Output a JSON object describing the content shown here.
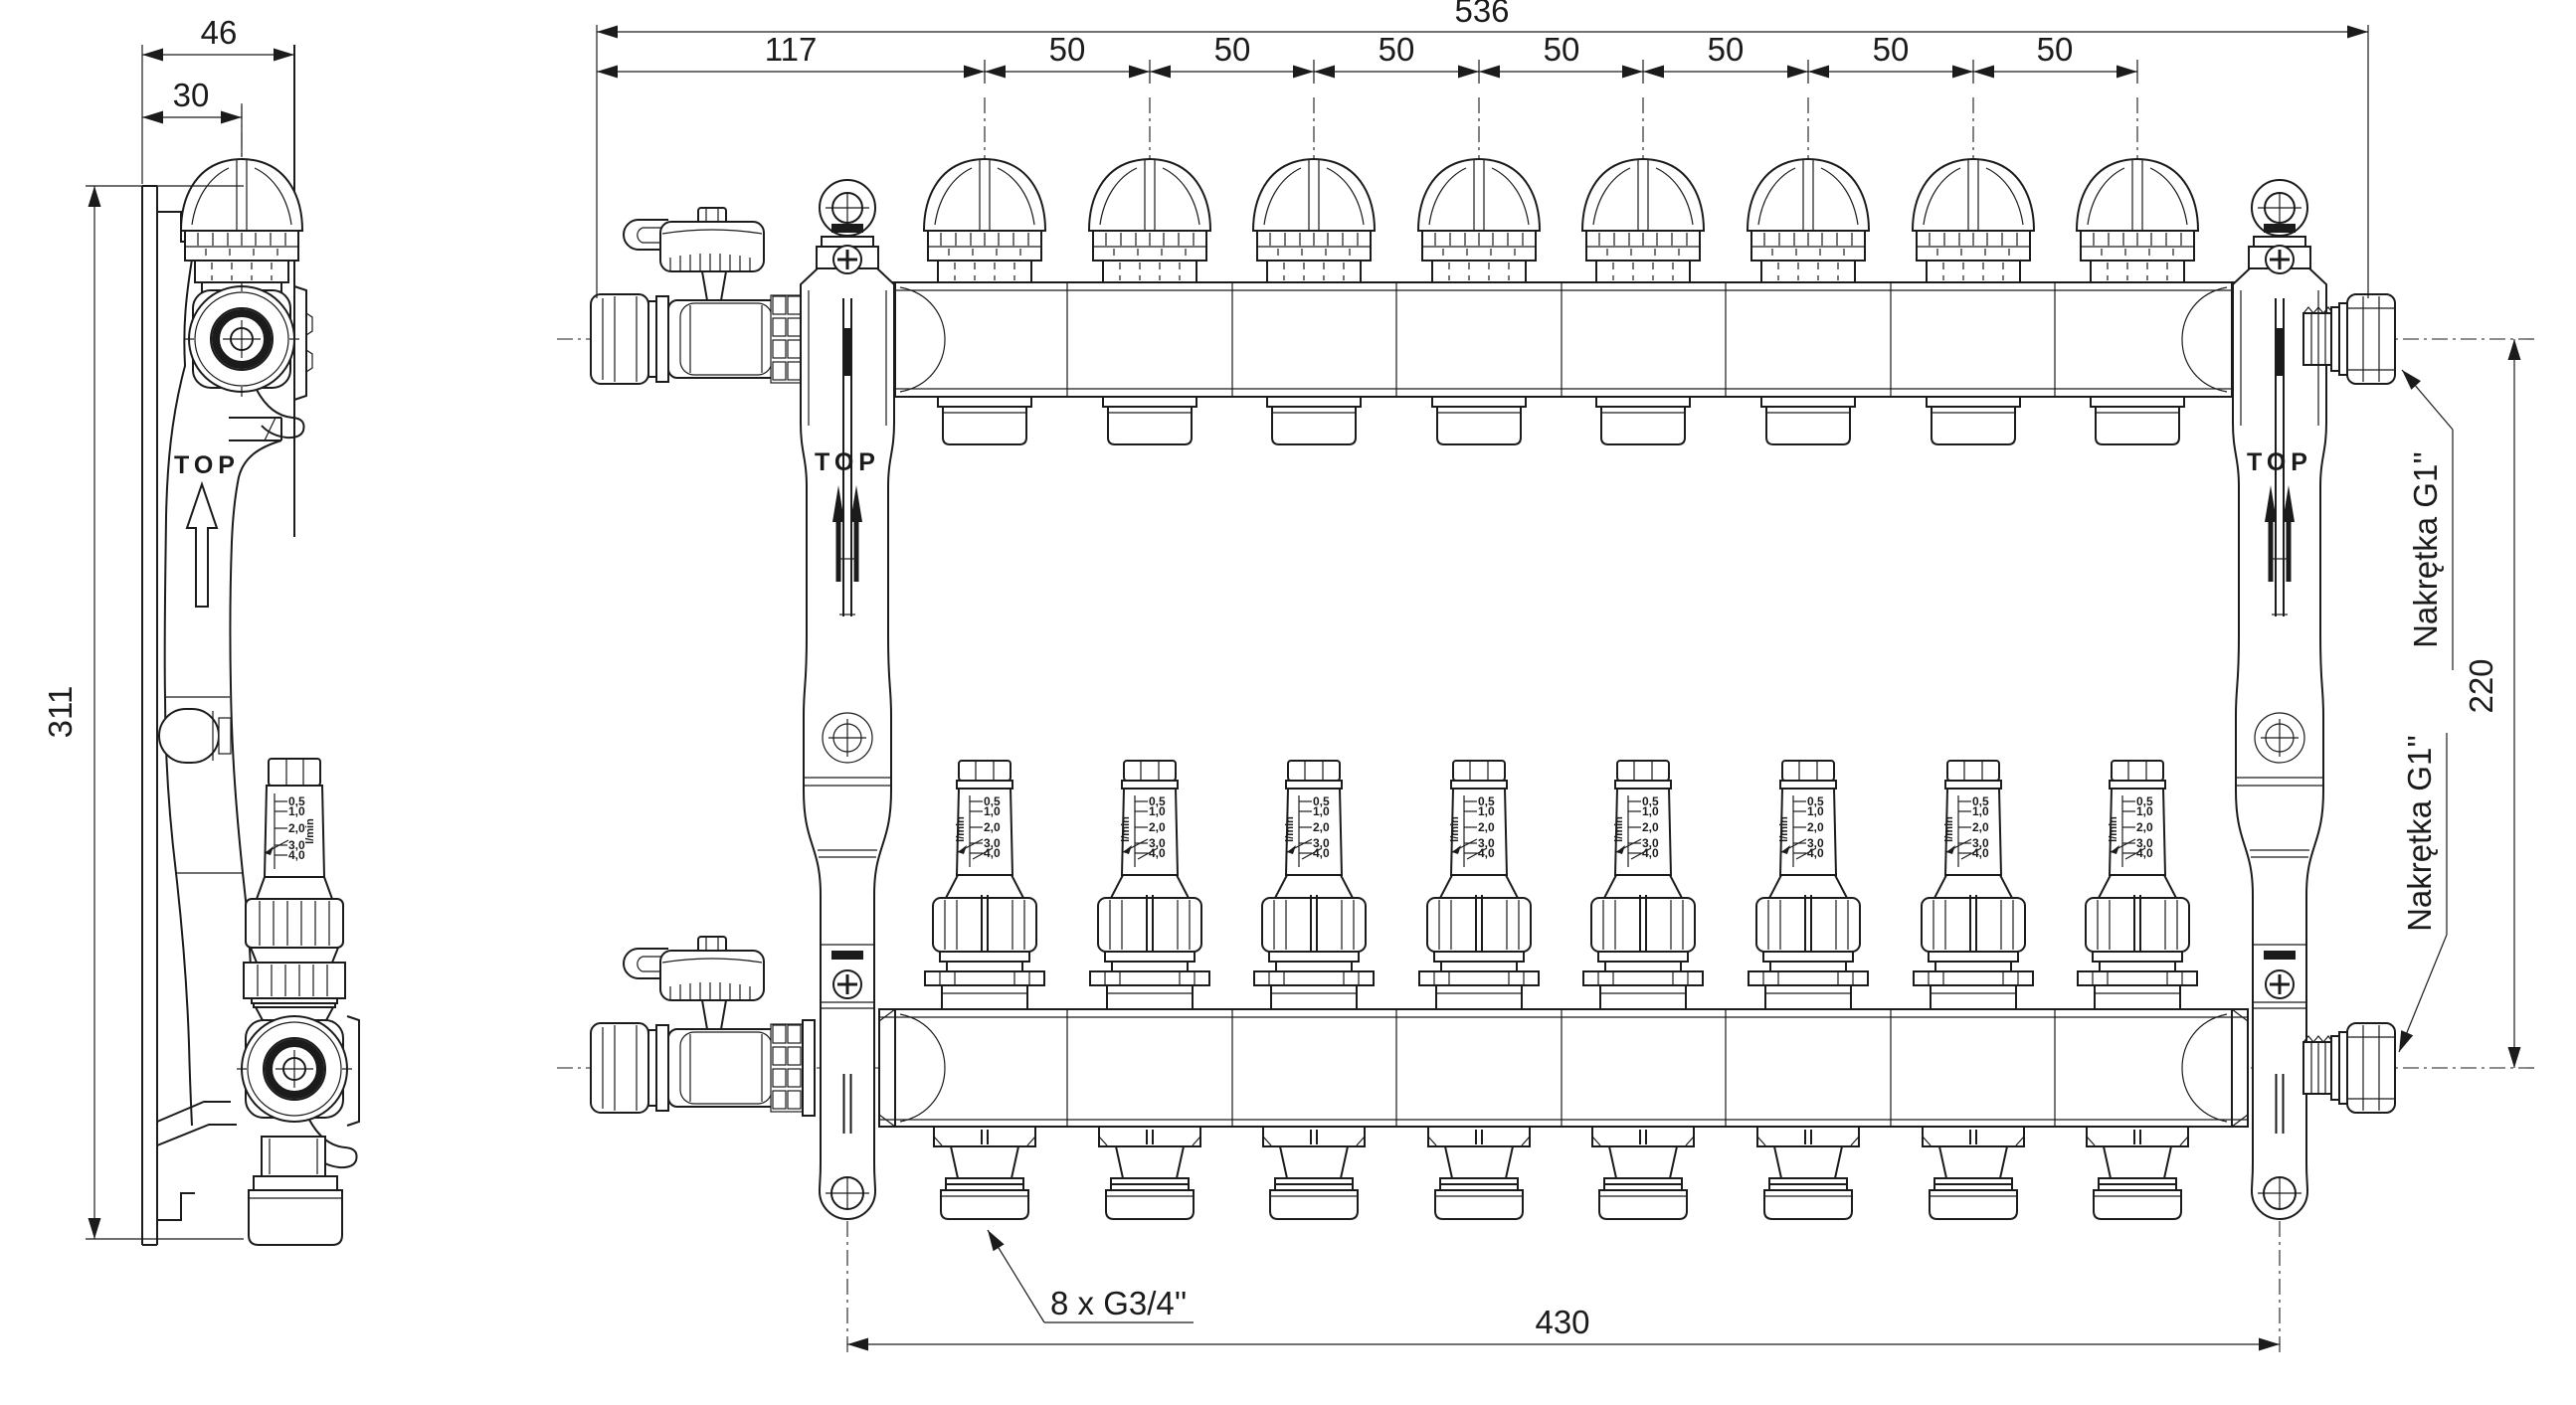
{
  "drawing": {
    "background": "#ffffff",
    "line_color": "#1b1b1b",
    "views": {
      "side_view": {
        "dim_width_total": "46",
        "dim_width_offset": "30",
        "dim_height": "311",
        "top_marking": "TOP"
      },
      "front_view": {
        "dim_total_width": "536",
        "dim_first_pitch": "117",
        "dim_loop_pitch_labels": [
          "50",
          "50",
          "50",
          "50",
          "50",
          "50",
          "50"
        ],
        "dim_axis_distance": "220",
        "dim_bracket_distance": "430",
        "label_union_nut_top": "Nakrętka G1''",
        "label_union_nut_bottom": "Nakrętka G1''",
        "label_loop_outlets": "8 x G3/4''",
        "top_marking": "TOP"
      },
      "flow_meter_scale": {
        "unit": "l/min",
        "ticks": [
          "0,5",
          "1,0",
          "2,0",
          "3,0",
          "4,0"
        ]
      }
    }
  }
}
